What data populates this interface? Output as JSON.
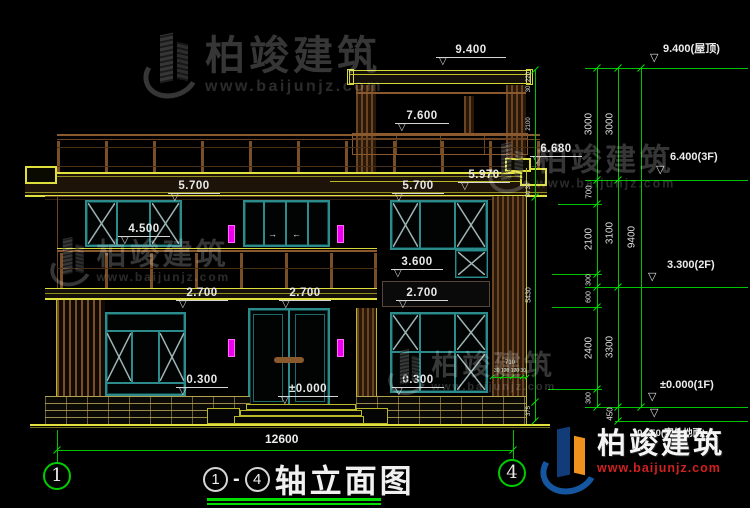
{
  "watermark": {
    "brand": "柏竣建筑",
    "url": "www.baijunjz.com"
  },
  "footer": {
    "brand": "柏竣建筑",
    "url": "www.baijunjz.com"
  },
  "title": {
    "bubble_left": "1",
    "dash": "-",
    "bubble_right": "4",
    "text": "轴立面图"
  },
  "axis": {
    "left": "1",
    "right": "4"
  },
  "symbols": {
    "level_triangle": "▽",
    "arrow_left": "←",
    "arrow_right": "→"
  },
  "overall": {
    "width": "12600"
  },
  "levels": {
    "roof": "9.400",
    "penthouse_rail": "7.600",
    "parapet": "6.680",
    "fascia": "5.970",
    "win_top_left": "5.700",
    "win_top_right": "5.700",
    "sill_2f": "4.500",
    "sill_3600": "3.600",
    "balcony_left": "2.700",
    "balcony_center": "2.700",
    "balcony_right": "2.700",
    "sill_1f_left": "0.300",
    "sill_1f_right": "0.300",
    "floor_1f": "±0.000"
  },
  "right_levels": {
    "roof": "9.400(屋顶)",
    "f3": "6.400(3F)",
    "f2": "3.300(2F)",
    "f1": "±0.000(1F)",
    "grade": "-0.450(室外地面)"
  },
  "chain_a": {
    "s1": "3000",
    "s2": "700",
    "s3": "2100",
    "s4": "300",
    "s5": "600",
    "s6": "2400",
    "s7": "300"
  },
  "chain_b": {
    "s1": "3000",
    "s2": "3100",
    "s3": "3300",
    "s4": "450"
  },
  "chain_c": {
    "s1": "9400"
  },
  "chain_edge": {
    "s1": "220",
    "s2": "30",
    "s3": "2100",
    "s4": "30",
    "s5": "50",
    "total": "5430",
    "base": "375"
  },
  "chain_door": {
    "total": "710",
    "parts": "30 120 120 30"
  }
}
